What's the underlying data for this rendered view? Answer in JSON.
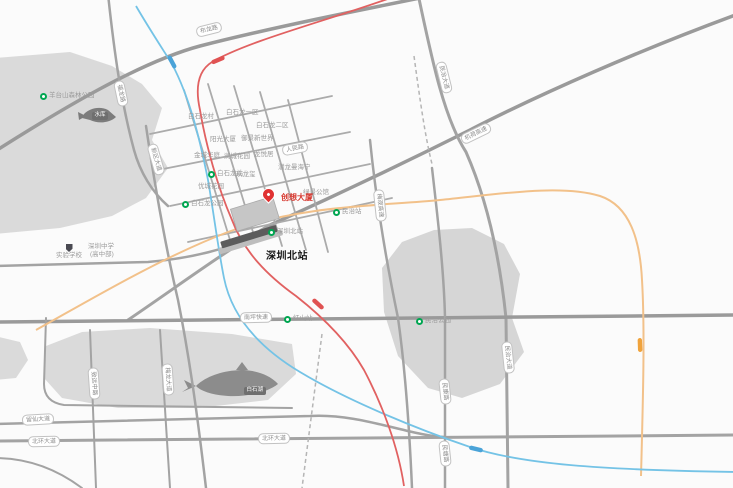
{
  "landmark": {
    "pin_label": "创想大厦",
    "station_label": "深圳北站"
  },
  "colors": {
    "road": "#a3a3a3",
    "park": "#dadada",
    "water": "#7c7c7c",
    "metro_blue": "#74c3e6",
    "metro_red": "#e16161",
    "rail_orange": "#f2c18a",
    "pin_red": "#e03131",
    "metro_green": "#00a651"
  },
  "road_pills": [
    {
      "text": "布龙路"
    },
    {
      "text": "福龙路"
    },
    {
      "text": "新区大道"
    },
    {
      "text": "人民路"
    },
    {
      "text": "民治大道"
    },
    {
      "text": "机荷高速"
    },
    {
      "text": "梅观高速"
    },
    {
      "text": "南坪快速"
    },
    {
      "text": "留仙大道"
    },
    {
      "text": "北环大道"
    },
    {
      "text": "北环大道"
    },
    {
      "text": "民治大道"
    },
    {
      "text": "民康路"
    },
    {
      "text": "民塘路"
    },
    {
      "text": "致远中路"
    },
    {
      "text": "梅龙大道"
    }
  ],
  "pois": [
    {
      "text": "白石龙村"
    },
    {
      "text": "白石龙一区"
    },
    {
      "text": "白石龙二区"
    },
    {
      "text": "阳光大厦"
    },
    {
      "text": "御景新世界"
    },
    {
      "text": "金城华庭"
    },
    {
      "text": "润城花园"
    },
    {
      "text": "龙悦居"
    },
    {
      "text": "优城花园"
    },
    {
      "text": "玖龙玺"
    },
    {
      "text": "潜龙曼海宁"
    },
    {
      "text": "绿景公馆"
    },
    {
      "text": "民治站",
      "icon": "metro"
    },
    {
      "text": "白石龙站",
      "icon": "metro"
    },
    {
      "text": "深圳北站",
      "icon": "metro"
    },
    {
      "text": "红山站",
      "icon": "metro"
    },
    {
      "text": "白石龙公园",
      "icon": "park"
    },
    {
      "text": "民治公园",
      "icon": "park"
    },
    {
      "text": "羊台山森林公园",
      "icon": "park"
    },
    {
      "text": "深圳中学"
    },
    {
      "text": "(高中部)"
    },
    {
      "text": "实验学校",
      "icon": "shield"
    }
  ],
  "water_badges": [
    {
      "text": "水库"
    },
    {
      "text": "白石湖"
    }
  ]
}
